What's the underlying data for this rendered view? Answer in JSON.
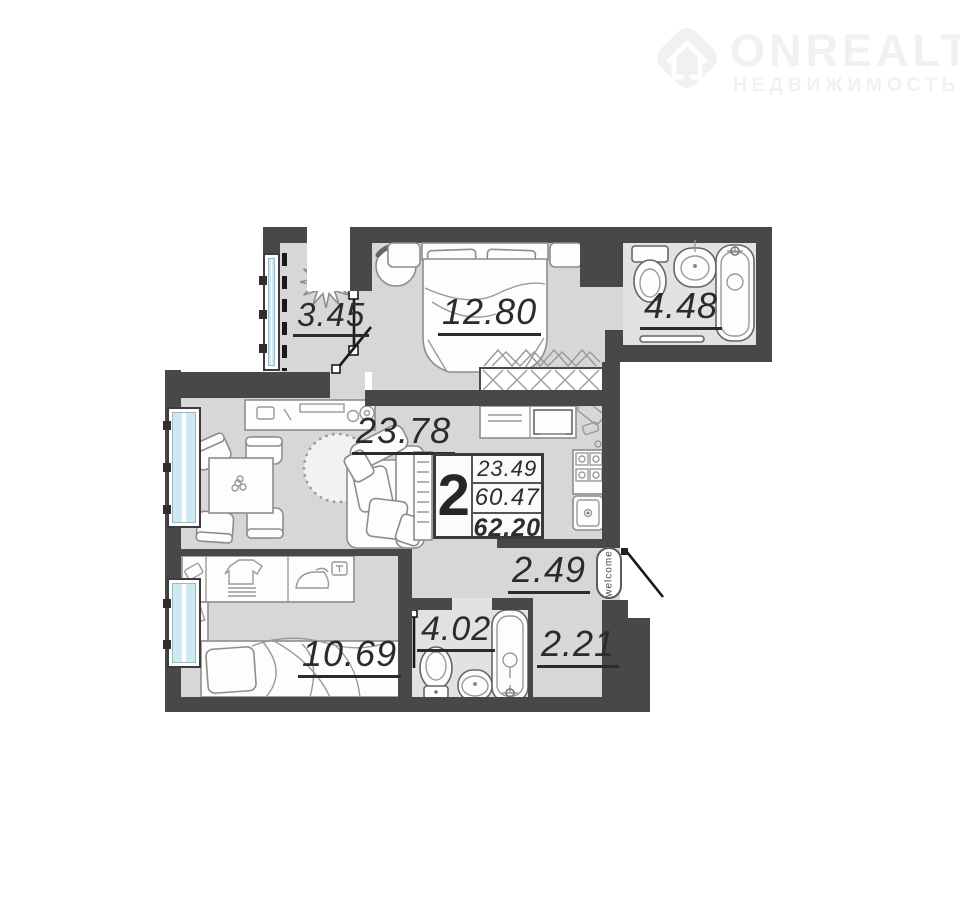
{
  "logo": {
    "brand": "ONREALT",
    "subtitle": "НЕДВИЖИМОСТЬ"
  },
  "stats": {
    "rooms_count": "2",
    "living_area": "23.49",
    "floor_area": "60.47",
    "total_area": "62.20"
  },
  "rooms": [
    {
      "name": "balcony",
      "area": "3.45"
    },
    {
      "name": "bedroom",
      "area": "12.80"
    },
    {
      "name": "bathroom",
      "area": "4.48"
    },
    {
      "name": "living-room",
      "area": "23.78"
    },
    {
      "name": "hallway",
      "area": "2.49"
    },
    {
      "name": "bedroom-2",
      "area": "10.69"
    },
    {
      "name": "bathroom-2",
      "area": "4.02"
    },
    {
      "name": "hall-2",
      "area": "2.21"
    }
  ],
  "entrance_mat": "welcome",
  "colors": {
    "wall": "#484848",
    "floor": "#d7d7d7",
    "bath_floor": "#e2e2e2",
    "glass": "#cdeaf2",
    "ink": "#2b2b2b",
    "logo": "#f1f1f1"
  }
}
